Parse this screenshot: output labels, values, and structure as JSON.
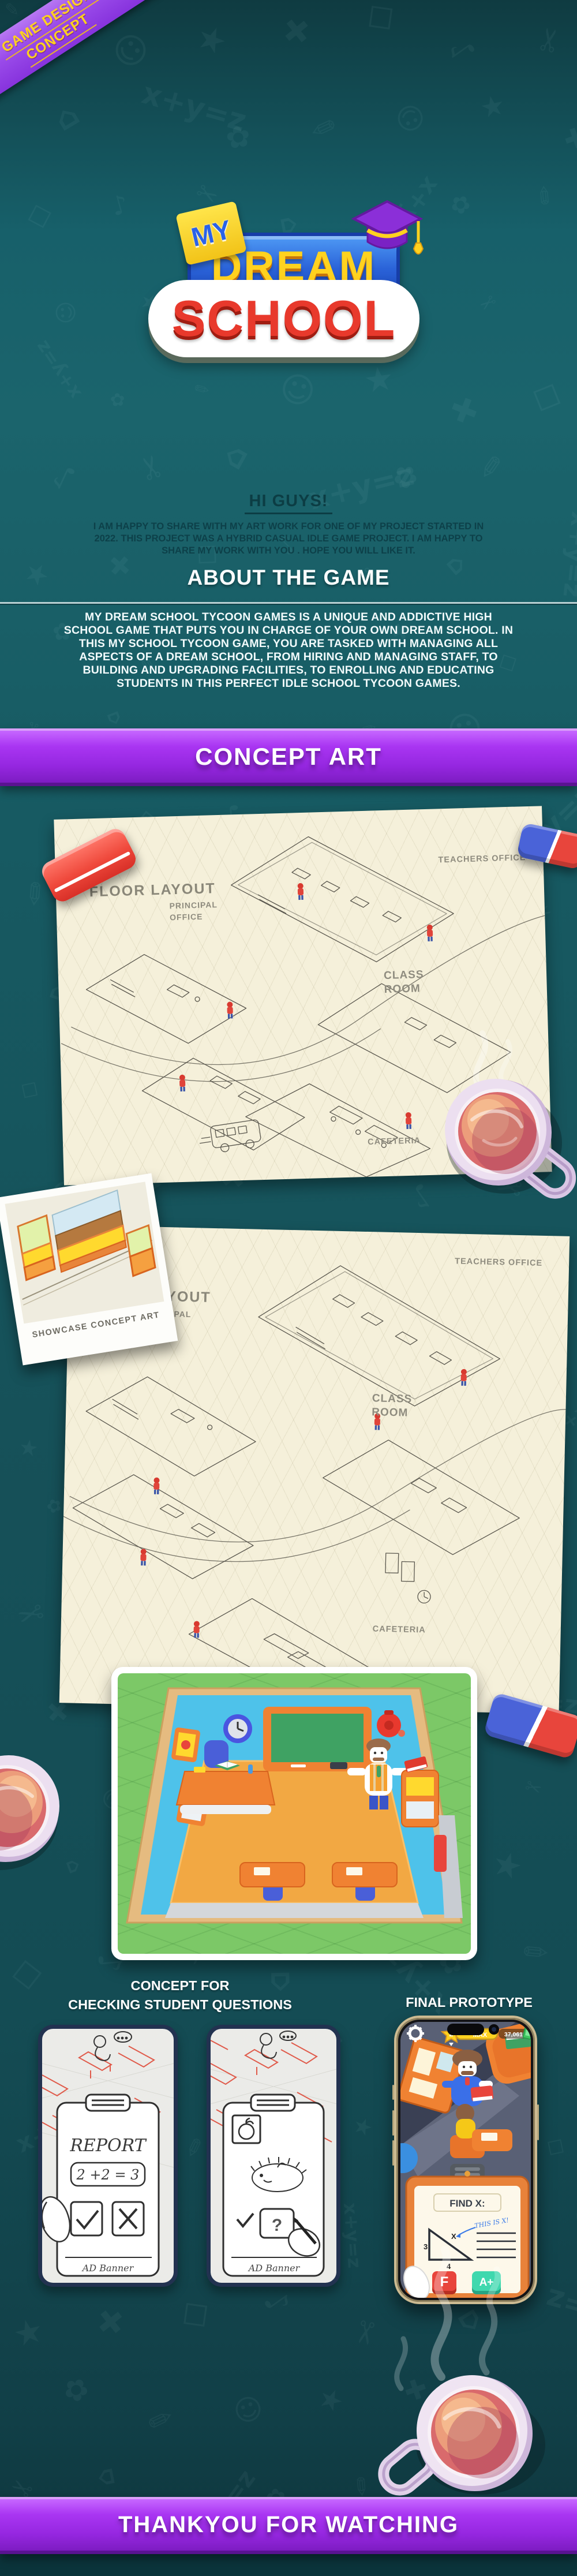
{
  "ribbon": {
    "line1": "GAME DESIGN",
    "line2": "CONCEPT"
  },
  "logo": {
    "my": "MY",
    "dream": "DREAM",
    "school": "SCHOOL"
  },
  "intro": {
    "heading": "HI GUYS!",
    "body": "I AM HAPPY TO SHARE WITH MY ART WORK FOR ONE OF MY PROJECT STARTED IN 2022. THIS PROJECT WAS A HYBRID CASUAL IDLE GAME PROJECT. I AM HAPPY TO SHARE MY WORK WITH YOU . HOPE YOU WILL LIKE IT."
  },
  "about": {
    "heading": "ABOUT THE GAME",
    "body": "MY DREAM SCHOOL TYCOON GAMES IS A UNIQUE AND ADDICTIVE HIGH SCHOOL GAME THAT PUTS YOU IN CHARGE OF YOUR OWN DREAM SCHOOL. IN THIS MY SCHOOL TYCOON GAME, YOU ARE TASKED WITH MANAGING ALL ASPECTS OF A DREAM SCHOOL, FROM HIRING AND MANAGING STAFF, TO BUILDING AND UPGRADING FACILITIES, TO ENROLLING AND EDUCATING STUDENTS IN THIS PERFECT IDLE SCHOOL TYCOON GAMES."
  },
  "concept_art": {
    "banner": "CONCEPT ART",
    "floorplan1": {
      "title": "FLOOR LAYOUT",
      "teachers_office": "TEACHERS OFFICE",
      "principal_line1": "PRINCIPAL",
      "principal_line2": "OFFICE",
      "class_line1": "CLASS",
      "class_line2": "ROOM",
      "cafeteria": "CAFETERIA"
    },
    "showcase_caption": "SHOWCASE CONCEPT ART",
    "floorplan2": {
      "title": "FLOOR LAYOUT",
      "teachers_office": "TEACHERS OFFICE",
      "principal_line1": "PRINCIPAL",
      "principal_line2": "OFFICE",
      "class_line1": "CLASS",
      "class_line2": "ROOM",
      "cafeteria": "CAFETERIA"
    }
  },
  "classroom": {
    "heading": "CLASS ROOM"
  },
  "sketches": {
    "heading_line1": "CONCEPT FOR",
    "heading_line2": "CHECKING STUDENT QUESTIONS",
    "sketch1": {
      "title": "REPORT",
      "equation": "2 +2 = 3",
      "ad_label": "AD Banner"
    },
    "sketch2": {
      "question_mark": "?",
      "ad_label": "AD Banner"
    }
  },
  "prototype": {
    "heading": "FINAL PROTOTYPE",
    "hud": {
      "level": "2",
      "max_label": "MAX",
      "coins": "37,061"
    },
    "clipboard": {
      "title": "FIND X:",
      "annotation": "THIS IS X!",
      "side_a": "3",
      "side_b": "4",
      "side_x": "X",
      "grade_fail": "F",
      "grade_pass": "A+"
    }
  },
  "footer": {
    "text": "THANKYOU FOR WATCHING"
  },
  "colors": {
    "background_teal": "#165159",
    "banner_purple": "#9a2fe8",
    "ribbon_yellow": "#ffd21f",
    "paper_cream": "#f5f0da",
    "accent_red": "#e8453c",
    "logo_blue": "#2a62d8",
    "logo_red": "#e8392c",
    "grade_fail_red": "#e84b3c",
    "grade_pass_teal": "#3fd8ae"
  }
}
